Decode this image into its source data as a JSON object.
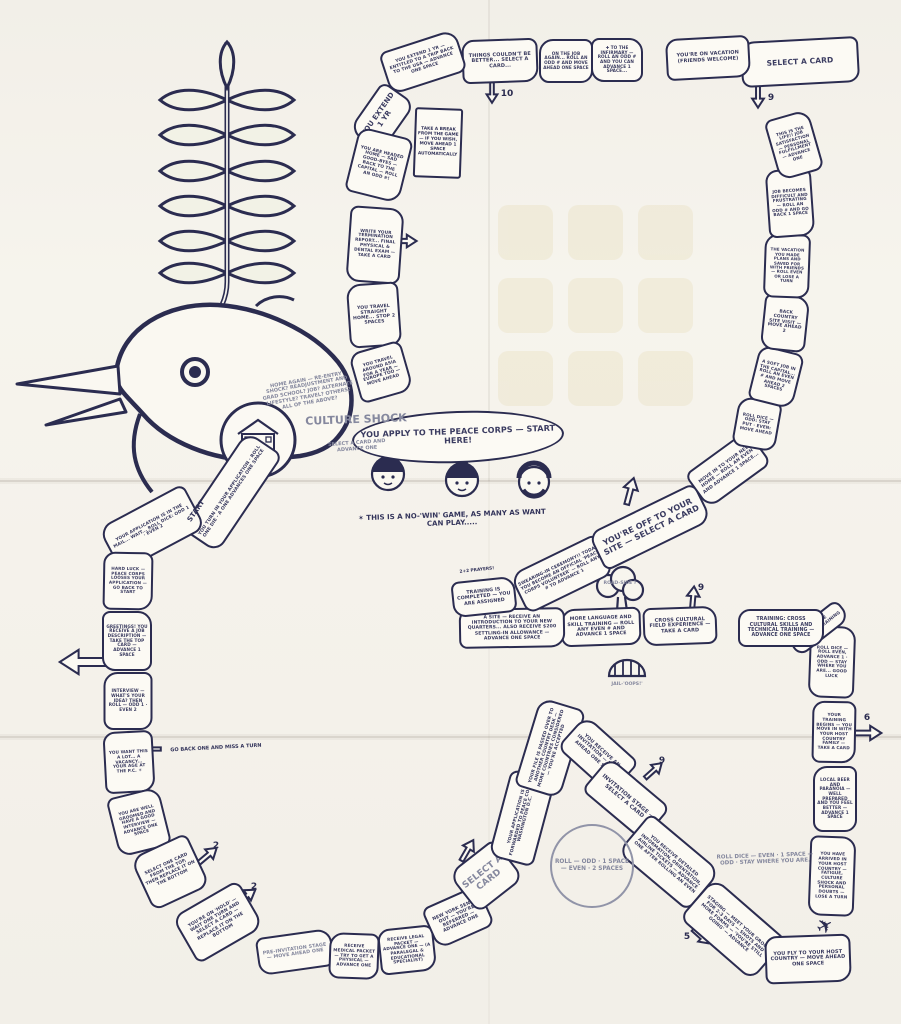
{
  "colors": {
    "background": "#f2efe8",
    "paper": "#fcfaf4",
    "ink": "#2b2c50",
    "pencil": "#85889e",
    "stain": "#dcca8f"
  },
  "decorations": {
    "home_label": "HOME",
    "roadside_label": "ROAD-SIDE ?",
    "jail_label": "JAIL-'OOPS!'",
    "plane_icon": "✈"
  },
  "annotations": [
    {
      "name": "take-a-break-card",
      "label": "TAKE A BREAK FROM THE GAME — IF YOU WISH, MOVE AHEAD 1 SPACE AUTOMATICALLY"
    },
    {
      "name": "culture-shock-title",
      "label": "CULTURE SHOCK"
    },
    {
      "name": "culture-shock-sub",
      "label": "SELECT A CARD AND ADVANCE ONE"
    },
    {
      "name": "home-again-note",
      "label": "HOME AGAIN — RE-ENTRY SHOCK? READJUSTMENT AND GRAD SCHOOL? JOB? ALTERNATE LIFESTYLE? TRAVEL? OTHERS? ALL OF THE ABOVE?"
    },
    {
      "name": "no-win-note",
      "label": "✶ THIS IS A NO-'WIN' GAME, AS MANY AS WANT CAN PLAY....."
    },
    {
      "name": "roll-circle",
      "label": "ROLL — ODD · 1 SPACE — EVEN · 2 SPACES"
    },
    {
      "name": "roll-dice-note",
      "label": "ROLL DICE — EVEN · 1 SPACE — ODD · STAY WHERE YOU ARE."
    },
    {
      "name": "go-back-note",
      "label": "GO BACK ONE AND MISS A TURN"
    },
    {
      "name": "prayers-note",
      "label": "2+2 PRAYERS!"
    },
    {
      "name": "start-label",
      "label": "START"
    }
  ],
  "board": {
    "spaces": [
      {
        "name": "apply-start",
        "label": "YOU APPLY TO THE PEACE CORPS — START HERE!"
      },
      {
        "name": "turn-in-application",
        "label": "YOU TURN IN YOUR APPLICATION · ROLL ONE DIE · A ONE ADVANCES ONE SPACE"
      },
      {
        "name": "application-in-mail",
        "label": "YOUR APPLICATION IS IN THE MAIL... WAIT... ROLL DICE: ODD 1 · EVEN 2"
      },
      {
        "name": "hard-luck",
        "label": "HARD LUCK — PEACE CORPS LOOSES YOUR APPLICATION — GO BACK TO START"
      },
      {
        "name": "greetings-job-description",
        "label": "GREETINGS! YOU RECEIVE A JOB DESCRIPTION — TAKE THE TOP CARD — ADVANCE 1 SPACE"
      },
      {
        "name": "interview",
        "label": "INTERVIEW — WHAT'S YOUR IDEA? THEN ROLL — ODD 1 · EVEN 2"
      },
      {
        "name": "vacancy",
        "label": "YOU WANT THIS A LOT... A VACANCY... YOUR AGE AT THE P.C. ☀"
      },
      {
        "name": "well-groomed",
        "label": "YOU ARE WELL GROOMED AND HAVE A GOOD INTERVIEW — ADVANCE ONE SPACE"
      },
      {
        "name": "select-one-card",
        "label": "SELECT ONE CARD FROM THE TOP, THEN REPLACE IT ON THE BOTTOM"
      },
      {
        "name": "on-hold",
        "label": "YOU'RE ON 'HOLD' — WAIT ONE TURN AND SELECT A CARD — REPLACE IT ON THE BOTTOM"
      },
      {
        "name": "pre-invitation-stage",
        "label": "PRE-INVITATION STAGE — MOVE AHEAD ONE"
      },
      {
        "name": "medical-packet",
        "label": "RECEIVE MEDICAL PACKET — TRY TO GET A PHYSICAL — ADVANCE ONE"
      },
      {
        "name": "legal-packet",
        "label": "RECEIVE LEGAL PACKET — ADVANCE ONE — (A PARALEGAL & EDUCATIONAL SPECIALIST)"
      },
      {
        "name": "new-york-sends",
        "label": "NEW YORK SENDS OUT — YOU'RE REFERRED — ADVANCE ONE"
      },
      {
        "name": "select-a-card-script",
        "label": "SELECT A CARD"
      },
      {
        "name": "forwarded-to-washington",
        "label": "YOUR APPLICATION IS FORWARDED TO PEACE CORPS WASHINGTON D.C."
      },
      {
        "name": "file-passed-over",
        "label": "YOUR FILE IS PASSED OVER TO ANOTHER COUNTRY DESK — MORE COUNTRIES CONSIDERED — YOU'RE ACCEPTED"
      },
      {
        "name": "receive-invitation",
        "label": "YOU RECEIVE AN INVITATION — MOVE AHEAD ONE SPACE"
      },
      {
        "name": "invitation-stage",
        "label": "INVITATION STAGE — SELECT A CARD"
      },
      {
        "name": "detailed-information",
        "label": "YOU RECEIVE DETAILED INFORMATION, ORIENTATION, AIRLINE TICKETS — ADVANCE ONE AFTER ROLLING AN EVEN"
      },
      {
        "name": "staging",
        "label": "STAGING — MEET YOUR GROUP FOR 2-3 DAYS — SHOTS AND MORE FORMS — 'YOU'RE STILL GOING' — ADVANCE"
      },
      {
        "name": "fly-to-host-country",
        "label": "YOU FLY TO YOUR HOST COUNTRY — MOVE AHEAD ONE SPACE"
      },
      {
        "name": "arrived-host-country",
        "label": "YOU HAVE ARRIVED IN YOUR HOST COUNTRY — FATIGUE, CULTURE SHOCK AND PERSONAL DOUBTS — LOSE A TURN"
      },
      {
        "name": "local-beer",
        "label": "LOCAL BEER AND PARANOIA — WELL PREPARED AND YOU FEEL BETTER — ADVANCE 1 SPACE"
      },
      {
        "name": "host-family",
        "label": "YOUR TRAINING BEGINS — YOU MOVE IN WITH YOUR HOST COUNTRY FAMILY — TAKE A CARD"
      },
      {
        "name": "language-roll-dice",
        "label": "ROLL DICE — ROLL EVEN, ADVANCE 1 · ODD — STAY WHERE YOU ARE... GOOD LUCK"
      },
      {
        "name": "intensive-language",
        "label": "INTENSIVE LANGUAGE TRAINING"
      },
      {
        "name": "cross-cultural-training",
        "label": "TRAINING: CROSS CULTURAL SKILLS AND TECHNICAL TRAINING — ADVANCE ONE SPACE"
      },
      {
        "name": "field-experience",
        "label": "CROSS CULTURAL FIELD EXPERIENCE — TAKE A CARD"
      },
      {
        "name": "more-language",
        "label": "MORE LANGUAGE AND SKILL TRAINING — ROLL ANY EVEN # AND ADVANCE 1 SPACE"
      },
      {
        "name": "a-site",
        "label": "A SITE — RECEIVE AN INTRODUCTION TO YOUR NEW QUARTERS... ALSO RECEIVE $200 SETTLING-IN ALLOWANCE — ADVANCE ONE SPACE"
      },
      {
        "name": "training-completed",
        "label": "TRAINING IS COMPLETED — YOU ARE ASSIGNED"
      },
      {
        "name": "swearing-in",
        "label": "SWEARING-IN CEREMONY!! TODAY YOU BECOME AN OFFICIAL 'PEACE CORPS VOLUNTEER' — ROLL ANY # TO ADVANCE 1"
      },
      {
        "name": "off-to-your-site",
        "label": "YOU'RE OFF TO YOUR SITE — SELECT A CARD"
      },
      {
        "name": "move-in",
        "label": "MOVE IN TO YOUR NEW HOME — ROLL AN EVEN AND ADVANCE 1 SPACE..."
      },
      {
        "name": "roll-dice-stay",
        "label": "ROLL DICE — ODD: STAY PUT · EVEN: MOVE AHEAD"
      },
      {
        "name": "soft-job-capital",
        "label": "A SOFT JOB IN THE CAPITAL... ROLL AN EVEN # AND MOVE AHEAD 2 SPACES"
      },
      {
        "name": "back-country-visit",
        "label": "BACK COUNTRY SITE VISIT — MOVE AHEAD 2"
      },
      {
        "name": "vacation-plans",
        "label": "THE VACATION YOU MADE PLANS AND SAVED FOR WITH FRIENDS — ROLL EVEN OR LOSE A TURN"
      },
      {
        "name": "job-difficult",
        "label": "JOB BECOMES DIFFICULT AND FRUSTRATING — ROLL AN ODD # AND GO BACK 1 SPACE"
      },
      {
        "name": "this-is-the-life",
        "label": "THIS IS THE LIFE!! JOB SATISFACTION — PERSONAL FULFILLMENT — ADVANCE ONE"
      },
      {
        "name": "select-a-card-top",
        "label": "SELECT A CARD"
      },
      {
        "name": "on-vacation",
        "label": "YOU'RE ON VACATION (FRIENDS WELCOME)"
      },
      {
        "name": "infirmary",
        "label": "✚ TO THE INFIRMARY — ROLL AN ODD # AND YOU CAN ADVANCE 1 SPACE..."
      },
      {
        "name": "on-the-job-again",
        "label": "ON THE JOB AGAIN... ROLL AN ODD # AND MOVE AHEAD ONE SPACE"
      },
      {
        "name": "things-couldnt-be-better",
        "label": "THINGS COULDN'T BE BETTER... SELECT A CARD..."
      },
      {
        "name": "extend-trip-usa",
        "label": "YOU EXTEND 1 YR — ENTITLED TO A TRIP BACK TO THE USA — ADVANCE ONE SPACE"
      },
      {
        "name": "you-extend",
        "label": "YOU EXTEND 1 YR"
      },
      {
        "name": "headed-home",
        "label": "YOU ARE HEADED HOME — SAD GOOD-BYES — BACK TO THE CAPITAL — ROLL AN ODD #!"
      },
      {
        "name": "termination-report",
        "label": "WRITE YOUR TERMINATION REPORT... FINAL PHYSICAL & DENTAL EXAM — TAKE A CARD"
      },
      {
        "name": "travel-straight-home",
        "label": "YOU TRAVEL STRAIGHT HOME... STOP 2 SPACES"
      },
      {
        "name": "travel-around",
        "label": "YOU TRAVEL AROUND ASIA FOR A YEAR — EUROPE TOO — MOVE AHEAD"
      }
    ],
    "arrows": [
      {
        "label": ""
      },
      {
        "label": ""
      },
      {
        "label": "2"
      },
      {
        "label": "2"
      },
      {
        "label": ""
      },
      {
        "label": ""
      },
      {
        "label": "9"
      },
      {
        "label": "9"
      },
      {
        "label": "6"
      },
      {
        "label": "5"
      },
      {
        "label": "9"
      },
      {
        "label": "10"
      },
      {
        "label": ""
      },
      {
        "label": ""
      }
    ]
  }
}
